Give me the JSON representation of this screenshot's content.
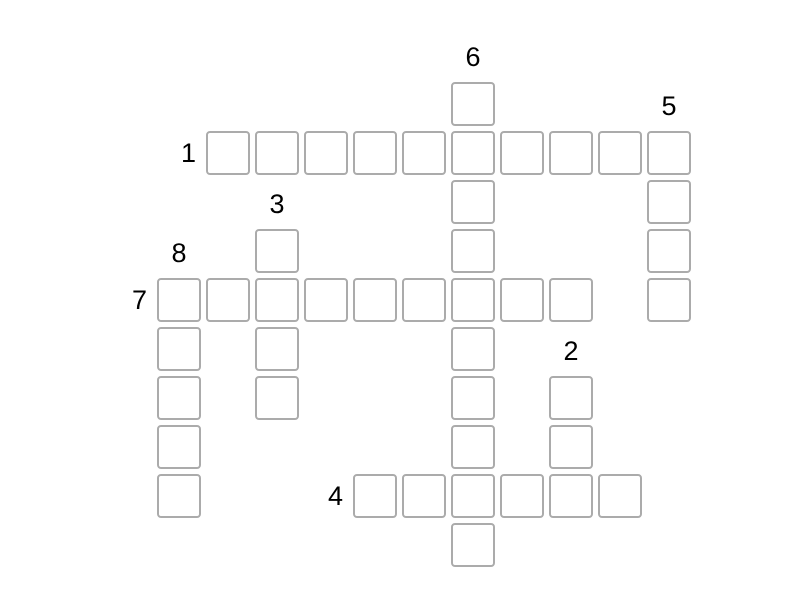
{
  "page": {
    "background_color": "#ffffff"
  },
  "crossword": {
    "cell_fill_color": "#ffffff",
    "cell_border_color": "#ababab",
    "number_color": "#000000",
    "cells_are_empty": true,
    "grid": {
      "origin_x": 157,
      "origin_y": 82,
      "pitch": 49,
      "cell_size": 44
    },
    "words": [
      {
        "number": "1",
        "direction": "across",
        "col": 1,
        "row": 1,
        "length": 10
      },
      {
        "number": "2",
        "direction": "down",
        "col": 8,
        "row": 6,
        "length": 3
      },
      {
        "number": "3",
        "direction": "down",
        "col": 2,
        "row": 3,
        "length": 4
      },
      {
        "number": "4",
        "direction": "across",
        "col": 4,
        "row": 8,
        "length": 6
      },
      {
        "number": "5",
        "direction": "down",
        "col": 10,
        "row": 1,
        "length": 4
      },
      {
        "number": "6",
        "direction": "down",
        "col": 6,
        "row": 0,
        "length": 10
      },
      {
        "number": "7",
        "direction": "across",
        "col": 0,
        "row": 4,
        "length": 9
      },
      {
        "number": "8",
        "direction": "down",
        "col": 0,
        "row": 4,
        "length": 5
      }
    ]
  }
}
